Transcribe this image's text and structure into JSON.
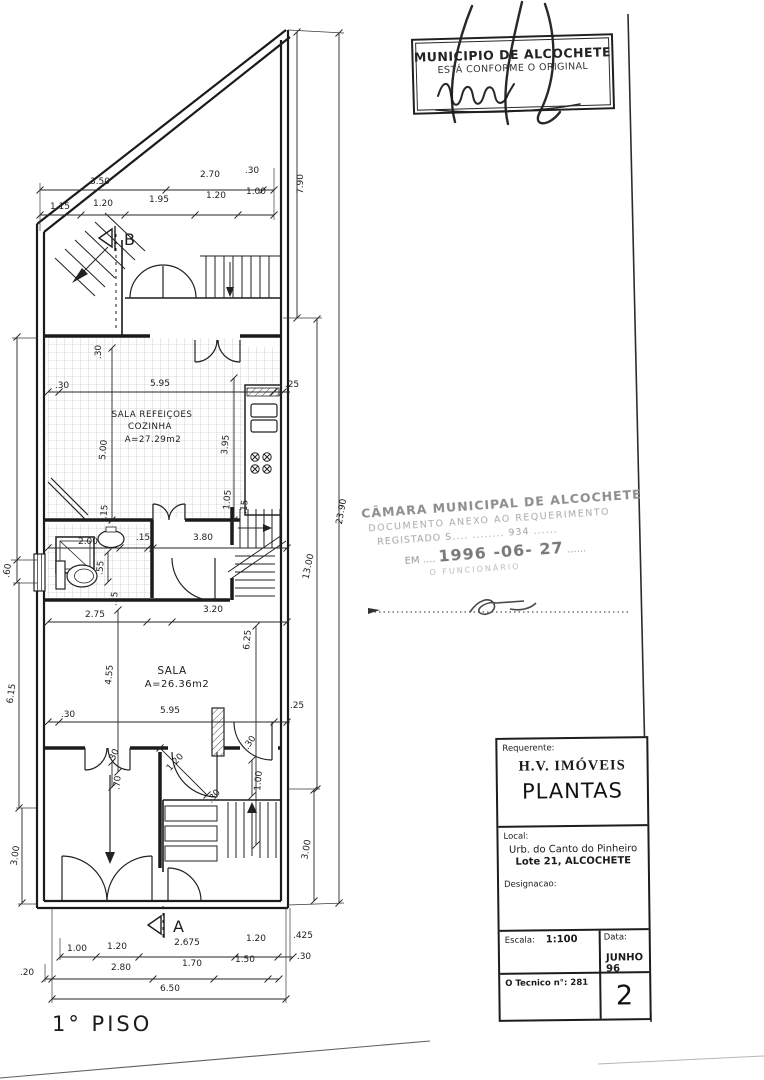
{
  "stamp_top": {
    "line1": "MUNICIPIO DE ALCOCHETE",
    "line2": "ESTÁ CONFORME O ORIGINAL"
  },
  "stamp_middle": {
    "line1": "CÂMARA MUNICIPAL DE ALCOCHETE",
    "line2": "DOCUMENTO ANEXO AO REQUERIMENTO",
    "line3": "REGISTADO S....  ........  934 ......",
    "line4_prefix": "EM ....",
    "line4_date": "1996 -06- 27",
    "line4_suffix": "......",
    "line5": "O FUNCIONÁRIO"
  },
  "title_block": {
    "requerente_label": "Requerente:",
    "requerente": "H.V. IMÓVEIS",
    "local_label": "Local:",
    "local_line1": "Urb. do Canto do Pinheiro",
    "local_line2": "Lote 21, ALCOCHETE",
    "designacao_label": "Designacao:",
    "designacao": "PLANTAS",
    "escala_label": "Escala:",
    "escala_value": "1:100",
    "data_label": "Data:",
    "data_value": "JUNHO 96",
    "tecnico_label": "O Tecnico n°: 281",
    "sheet_number": "2"
  },
  "floor_label": "1° PISO",
  "plan": {
    "rooms": [
      {
        "name": "SALA REFEIÇOES",
        "sub": "COZINHA",
        "area": "A=27.29m2"
      },
      {
        "name": "SALA",
        "area": "A=26.36m2"
      }
    ],
    "section_markers": [
      "B",
      "A"
    ],
    "labels": [
      {
        "t": "3.50",
        "x": 100,
        "y": 184
      },
      {
        "t": "2.70",
        "x": 210,
        "y": 177
      },
      {
        "t": ".30",
        "x": 252,
        "y": 173
      },
      {
        "t": "1.15",
        "x": 60,
        "y": 209
      },
      {
        "t": "1.20",
        "x": 103,
        "y": 206
      },
      {
        "t": "1.95",
        "x": 159,
        "y": 202
      },
      {
        "t": "1.20",
        "x": 216,
        "y": 198
      },
      {
        "t": "1.00",
        "x": 256,
        "y": 194
      },
      {
        "t": "7.90",
        "x": 303,
        "y": 184,
        "r": -90
      },
      {
        "t": "23.90",
        "x": 344,
        "y": 512,
        "r": -80
      },
      {
        "t": "13.00",
        "x": 311,
        "y": 567,
        "r": -78
      },
      {
        "t": "3.00",
        "x": 309,
        "y": 850,
        "r": -80
      },
      {
        "t": ".30",
        "x": 62,
        "y": 388
      },
      {
        "t": "5.95",
        "x": 160,
        "y": 386
      },
      {
        "t": ".25",
        "x": 292,
        "y": 387
      },
      {
        "t": "3.95",
        "x": 228,
        "y": 445,
        "r": -85
      },
      {
        "t": "5.00",
        "x": 106,
        "y": 450,
        "r": -85
      },
      {
        "t": ".30",
        "x": 101,
        "y": 352,
        "r": -90
      },
      {
        "t": "1.05",
        "x": 230,
        "y": 500,
        "r": -85
      },
      {
        "t": ".15",
        "x": 247,
        "y": 507,
        "r": -85
      },
      {
        "t": ".15",
        "x": 107,
        "y": 512,
        "r": -85
      },
      {
        "t": "2.00",
        "x": 88,
        "y": 544
      },
      {
        "t": ".15",
        "x": 143,
        "y": 540
      },
      {
        "t": "3.80",
        "x": 203,
        "y": 540
      },
      {
        "t": ".55",
        "x": 103,
        "y": 568,
        "r": -85
      },
      {
        "t": ".15",
        "x": 117,
        "y": 599,
        "r": -85
      },
      {
        "t": "2.75",
        "x": 95,
        "y": 617
      },
      {
        "t": "3.20",
        "x": 213,
        "y": 612
      },
      {
        "t": "6.25",
        "x": 250,
        "y": 640,
        "r": -85
      },
      {
        "t": "4.55",
        "x": 112,
        "y": 675,
        "r": -85
      },
      {
        "t": ".30",
        "x": 68,
        "y": 717
      },
      {
        "t": "5.95",
        "x": 170,
        "y": 713
      },
      {
        "t": ".25",
        "x": 297,
        "y": 708
      },
      {
        "t": "1.20",
        "x": 177,
        "y": 764,
        "r": -47
      },
      {
        "t": ".30",
        "x": 116,
        "y": 757,
        "r": -65
      },
      {
        "t": ".70",
        "x": 120,
        "y": 783,
        "r": -85
      },
      {
        "t": ".30",
        "x": 252,
        "y": 744,
        "r": -55
      },
      {
        "t": "1.00",
        "x": 261,
        "y": 781,
        "r": -85
      },
      {
        "t": ".30",
        "x": 216,
        "y": 798,
        "r": -50
      },
      {
        "t": "6.15",
        "x": 14,
        "y": 694,
        "r": -82
      },
      {
        "t": "3.00",
        "x": 18,
        "y": 856,
        "r": -82
      },
      {
        "t": ".60",
        "x": 10,
        "y": 571,
        "r": -82
      },
      {
        "t": "1.00",
        "x": 77,
        "y": 951
      },
      {
        "t": "1.20",
        "x": 117,
        "y": 949
      },
      {
        "t": "2.675",
        "x": 187,
        "y": 945
      },
      {
        "t": "1.20",
        "x": 256,
        "y": 941
      },
      {
        "t": ".425",
        "x": 303,
        "y": 938
      },
      {
        "t": ".20",
        "x": 27,
        "y": 975
      },
      {
        "t": "2.80",
        "x": 121,
        "y": 970
      },
      {
        "t": "1.70",
        "x": 192,
        "y": 966
      },
      {
        "t": "1.50",
        "x": 245,
        "y": 962
      },
      {
        "t": ".30",
        "x": 304,
        "y": 959
      },
      {
        "t": "6.50",
        "x": 170,
        "y": 991
      }
    ]
  }
}
